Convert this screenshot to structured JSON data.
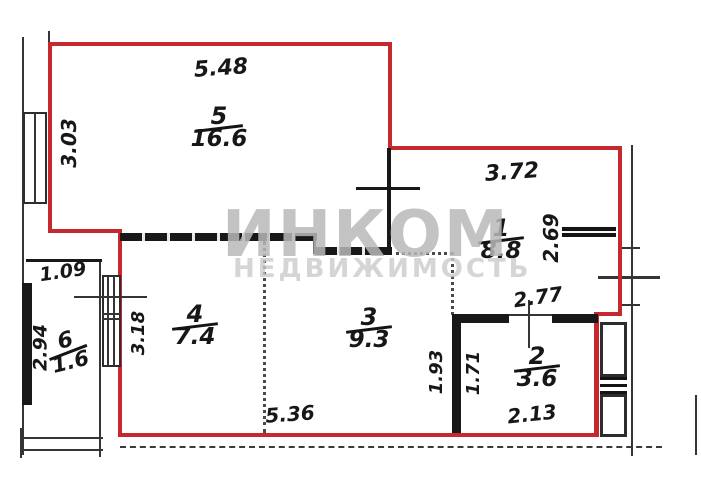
{
  "watermark": {
    "brand": "ИНКОМ",
    "subtitle": "НЕДВИЖИМОСТЬ"
  },
  "rooms": {
    "r5": {
      "number": "5",
      "area": "16.6"
    },
    "r1": {
      "number": "1",
      "area": "8.8"
    },
    "r4": {
      "number": "4",
      "area": "7.4"
    },
    "r3": {
      "number": "3",
      "area": "9.3"
    },
    "r2": {
      "number": "2",
      "area": "3.6"
    },
    "r6": {
      "number": "6",
      "area": "1.6"
    }
  },
  "dims": {
    "room5_width": "5.48",
    "room5_height": "3.03",
    "room1_width": "3.72",
    "room1_height": "2.69",
    "room2_top": "2.77",
    "room2_bottom": "2.13",
    "room2_height": "1.71",
    "room3_height": "1.93",
    "room3_width": "5.36",
    "room4_height": "3.18",
    "room6_width": "1.09",
    "room6_height": "2.94"
  }
}
